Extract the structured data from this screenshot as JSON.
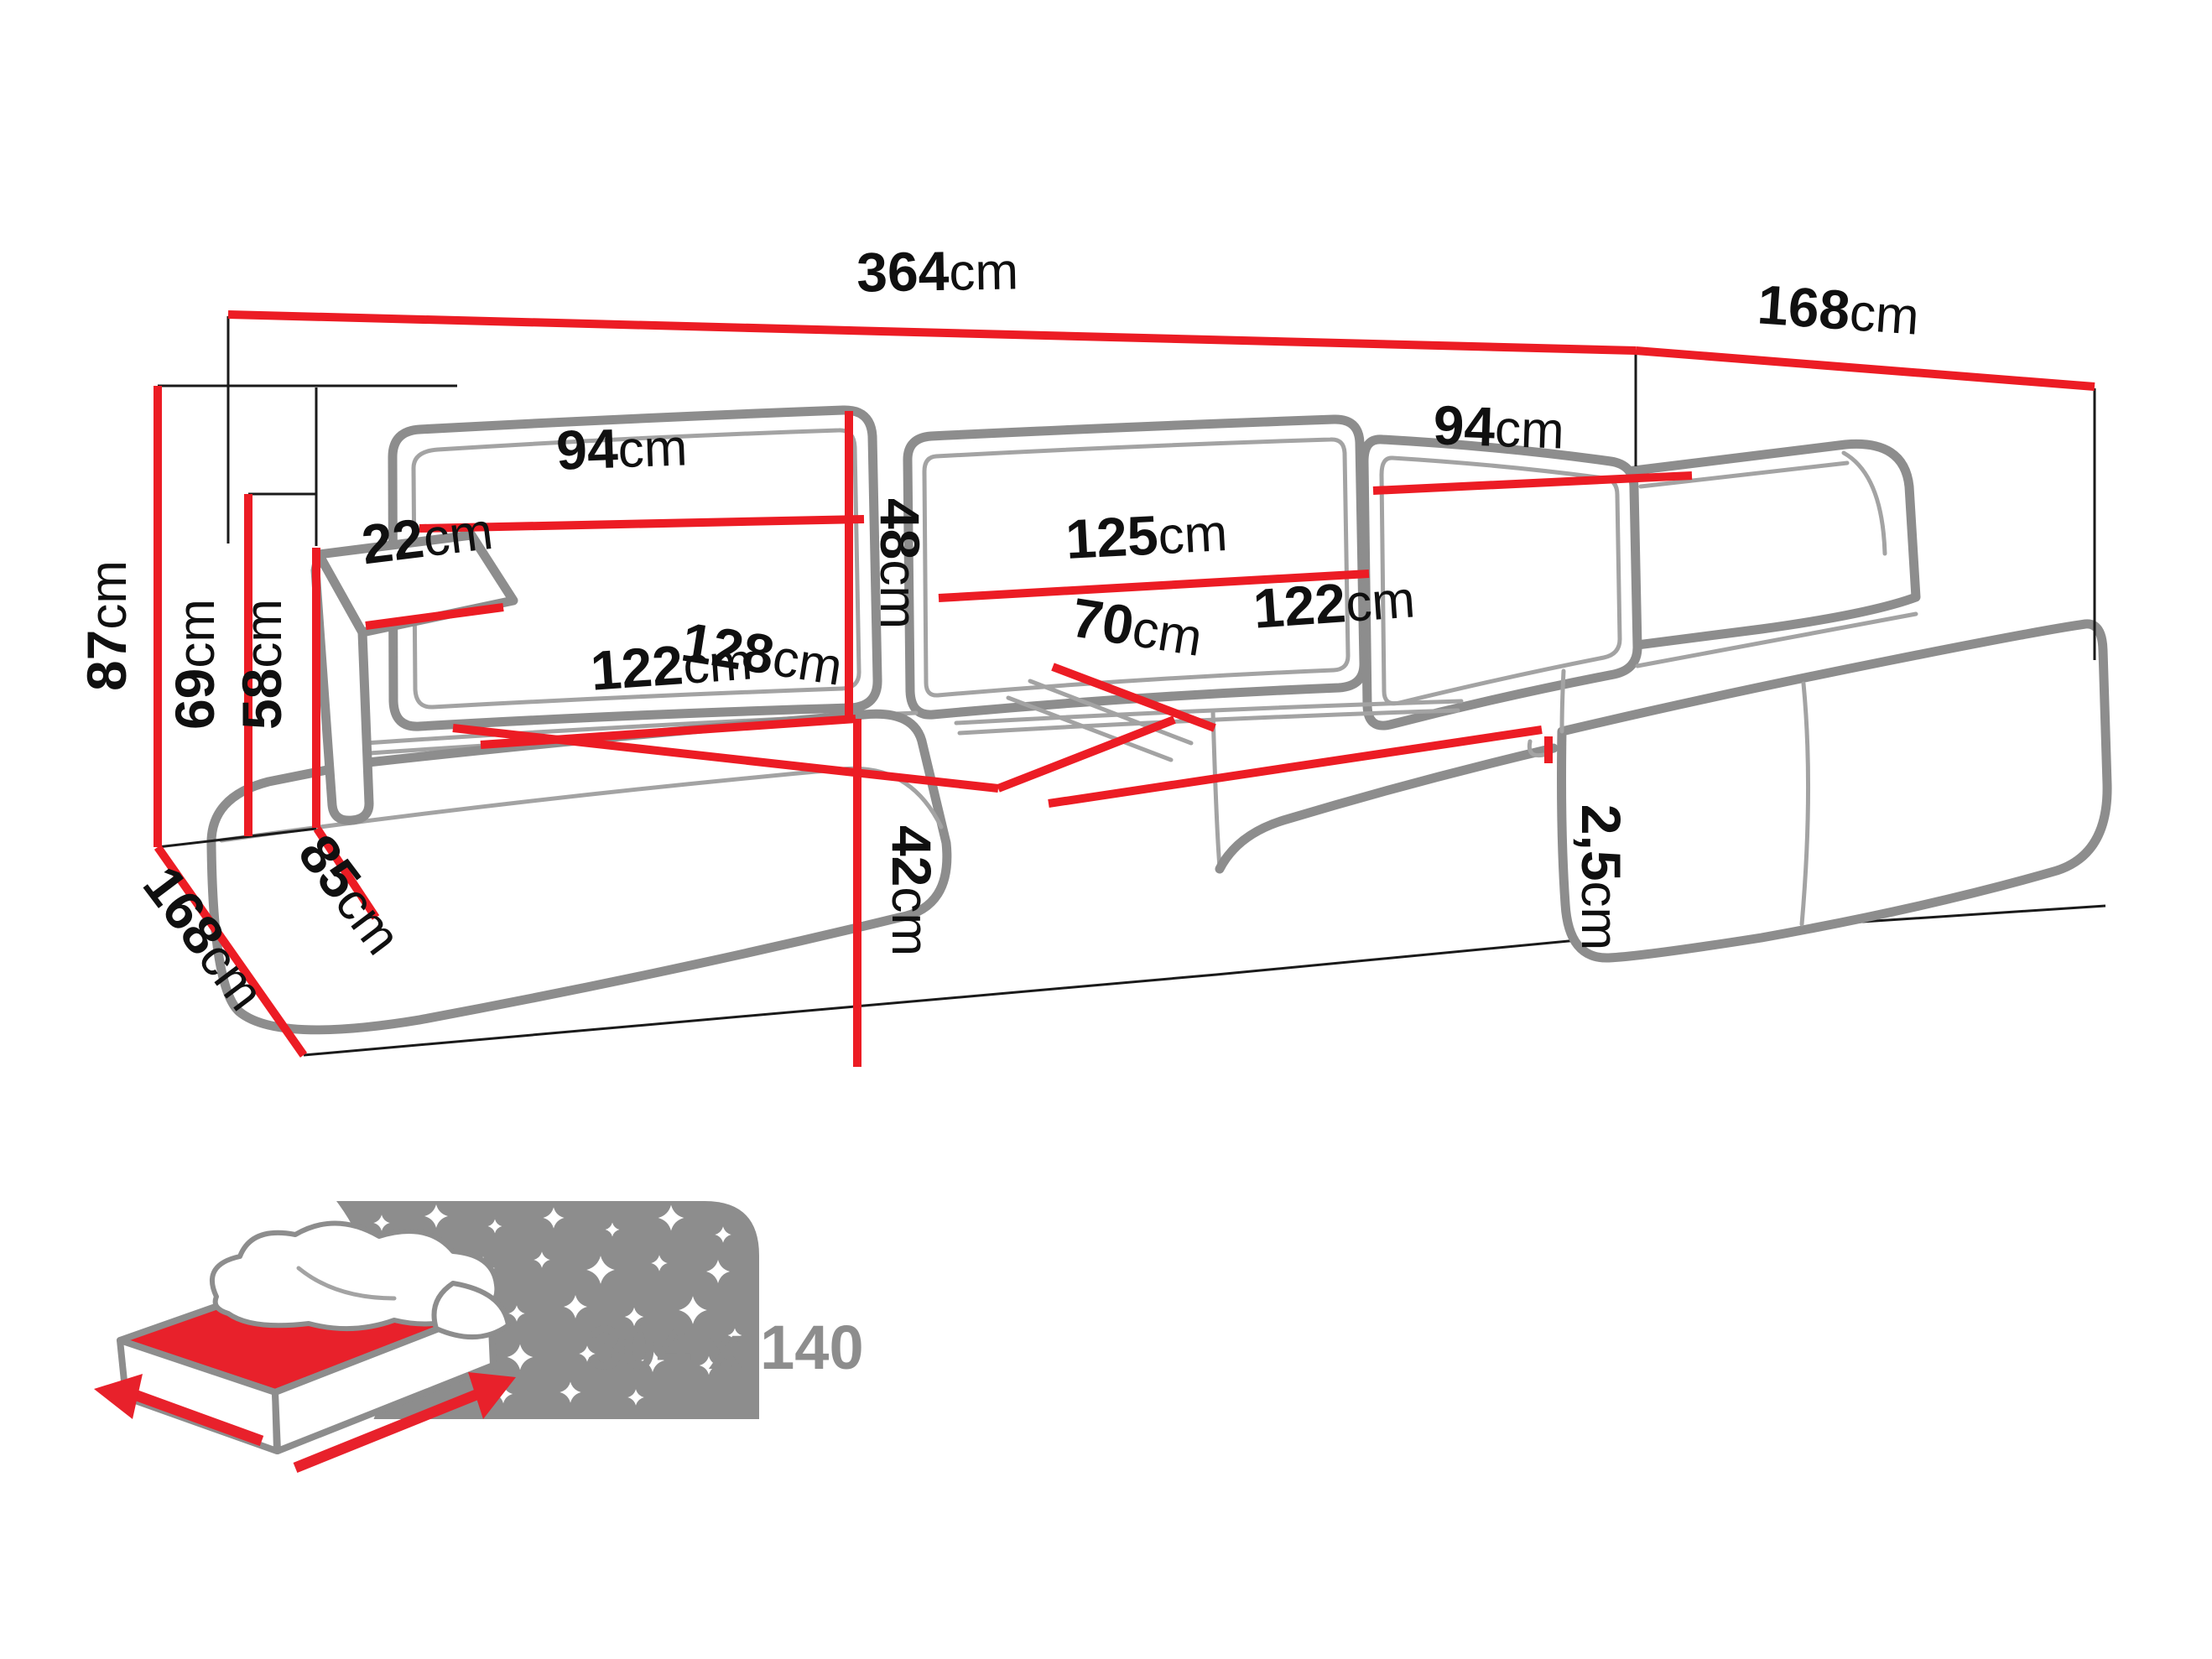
{
  "title": "corner-sofa-dimensions-diagram",
  "dims": {
    "total_width": {
      "num": "364",
      "unit": "cm"
    },
    "depth_right": {
      "num": "168",
      "unit": "cm"
    },
    "height_total": {
      "num": "87",
      "unit": "cm"
    },
    "armrest_height": {
      "num": "69",
      "unit": "cm"
    },
    "seat_back_height": {
      "num": "58",
      "unit": "cm"
    },
    "armrest_width": {
      "num": "22",
      "unit": "cm"
    },
    "backrest_left": {
      "num": "94",
      "unit": "cm"
    },
    "backrest_height": {
      "num": "48",
      "unit": "cm"
    },
    "backrest_middle": {
      "num": "125",
      "unit": "cm"
    },
    "backrest_right": {
      "num": "94",
      "unit": "cm"
    },
    "seat_diagonal": {
      "num": "128",
      "unit": "cm"
    },
    "seat_middle_depth": {
      "num": "70",
      "unit": "cm"
    },
    "seat_middle_width": {
      "num": "122",
      "unit": "cm"
    },
    "seat_left_width": {
      "num": "122",
      "unit": "cm"
    },
    "seat_height": {
      "num": "42",
      "unit": "cm"
    },
    "clearance": {
      "num": "2,5",
      "unit": "cm"
    },
    "depth_left": {
      "num": "168",
      "unit": "cm"
    },
    "armrest_depth": {
      "num": "85",
      "unit": "cm"
    }
  },
  "sleeping": {
    "size": "304 x 140"
  },
  "colors": {
    "dimension_line": "#ec1c24",
    "outline_gray": "#8d8d8d",
    "label_black": "#101010"
  }
}
